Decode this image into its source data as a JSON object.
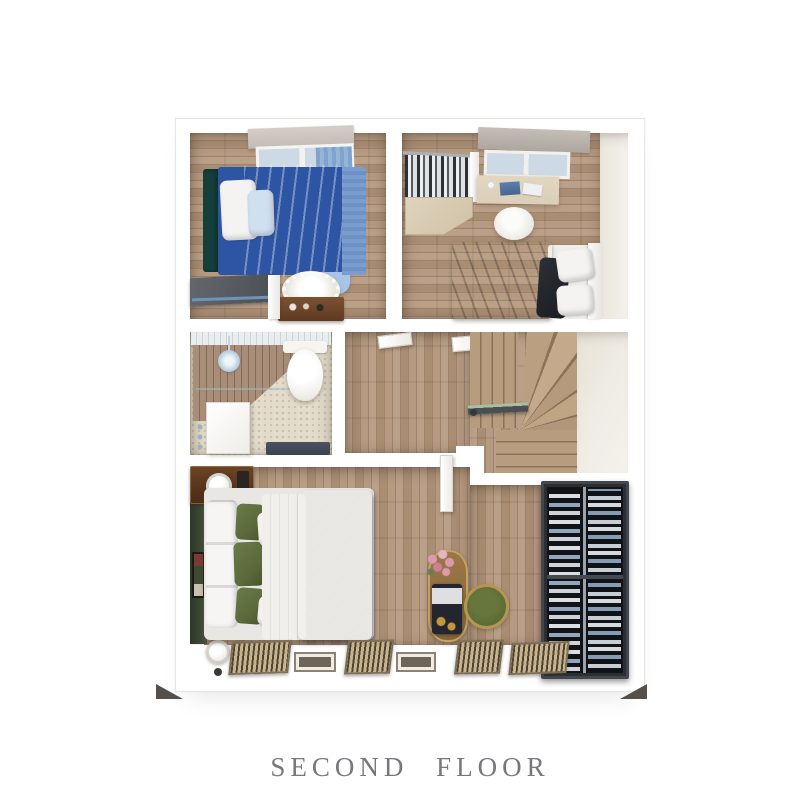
{
  "caption": {
    "title": "SECOND FLOOR"
  },
  "scene": {
    "type": "3d-floor-plan-top-view",
    "floor_label": "SECOND FLOOR",
    "rooms": [
      "bedroom-blue",
      "bedroom-green-desk",
      "bathroom",
      "hallway",
      "winder-staircase",
      "master-bedroom",
      "walk-in-closet"
    ],
    "furniture": [
      "single-bed-blue",
      "fluffy-rug",
      "nightstand",
      "shoe-rack",
      "clothes-rack",
      "study-desk",
      "desk-chair",
      "single-bed-green",
      "toilet",
      "shower-head",
      "bathroom-vanity",
      "bathroom-door",
      "double-bed-dark-blanket",
      "green-accent-wall",
      "wall-art",
      "dressing-table",
      "flower-bouquet",
      "round-stool",
      "wardrobe-hanging-clothes",
      "floor-vents",
      "table-lamps"
    ]
  },
  "palette": {
    "background": "#ffffff",
    "wall": "#ffffff",
    "wall_edge": "#e9e6e1",
    "caption_color": "#78777c",
    "wood_mid": "#b2957a",
    "wood_light": "#c4aa8b",
    "wood_dark": "#9d8166",
    "tile": "#e3dccb",
    "wood_wall": "#9c7f67",
    "blue_duvet": "#a9c7e9",
    "blue_base": "#2e55a4",
    "blue_headboard": "#143f3c",
    "blue_stripe": "#6c92c6",
    "pillow_white": "#f4f3f1",
    "pillow_blue": "#cfe0f1",
    "green_duvet": "#44512f",
    "dark_blanket": "#2e3238",
    "pillow_green": "#5c6a3c",
    "accent_green": "#3b4834",
    "closet_frame": "#43474d",
    "closet_dark": "#111316",
    "stool_green": "#586a34",
    "stool_rim": "#b59551",
    "desk_wood": "#dccfb8",
    "blind_gray": "#c2bcb5",
    "glass_blue": "#cdd9e4",
    "nightstand_wood": "#5f3a20",
    "vanity_dark": "#3c4350",
    "vent_wood": "#c9b38c",
    "vent_line": "#4d4433",
    "rail_blue": "#6e93b8",
    "lamp_white": "#efece6",
    "flower_pink": "#dd9aae",
    "foot_dark": "#55504b",
    "lit_floor": "#efece4"
  }
}
